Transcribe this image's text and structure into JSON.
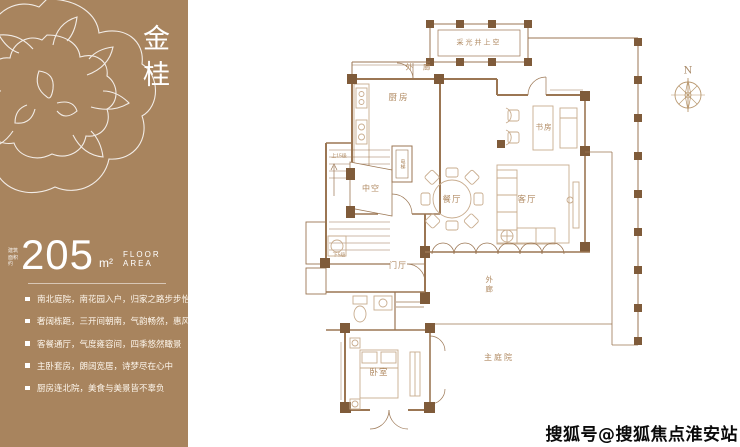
{
  "sidebar": {
    "title": "金桂",
    "area": {
      "note": "建筑面积约",
      "value": "205",
      "unit": "m²",
      "caption": "FLOOR AREA"
    },
    "bullets": [
      "南北庭院，南花园入户，归家之路步步怡情",
      "奢阔栋距，三开间朝南，气韵畅然，惠风习习",
      "客餐通厅，气度雍容间，四季悠然瞰景",
      "主卧套房，朗阔宽居，诗梦尽在心中",
      "厨房连北院，美食与美景皆不辜负"
    ]
  },
  "plan": {
    "labels": {
      "lightwell": "采光井上空",
      "corridor_top": "外 廊",
      "kitchen": "厨房",
      "elevator": "电梯",
      "stairs_up": "上15级",
      "stairs_down": "下5级",
      "void": "中空",
      "dining": "餐厅",
      "living": "客厅",
      "study": "书房",
      "foyer": "门厅",
      "corridor_right": "外廊",
      "bedroom": "卧室",
      "courtyard": "主庭院",
      "compass": "N"
    },
    "colors": {
      "wall": "#9b7653",
      "furniture": "#c8ac8e",
      "post": "#7f5b3a",
      "label": "#b08a62"
    }
  },
  "watermark": "搜狐号@搜狐焦点淮安站",
  "colors": {
    "sidebar_bg": "#a8845e",
    "sidebar_text": "#ffffff",
    "background": "#ffffff"
  }
}
